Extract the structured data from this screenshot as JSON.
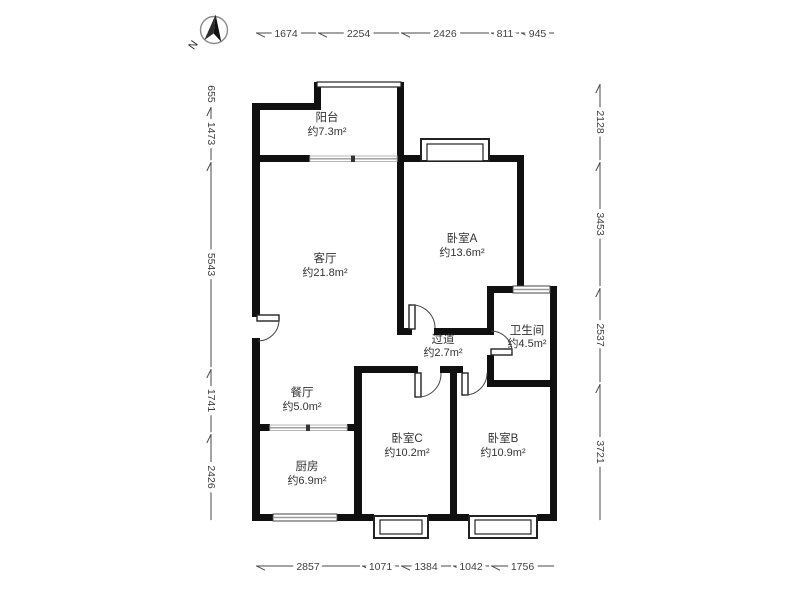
{
  "compass": {
    "label": "N"
  },
  "rooms": [
    {
      "id": "balcony",
      "name": "阳台",
      "area": "约7.3m²"
    },
    {
      "id": "living",
      "name": "客厅",
      "area": "约21.8m²"
    },
    {
      "id": "bedroomA",
      "name": "卧室A",
      "area": "约13.6m²"
    },
    {
      "id": "hallway",
      "name": "过道",
      "area": "约2.7m²"
    },
    {
      "id": "bathroom",
      "name": "卫生间",
      "area": "约4.5m²"
    },
    {
      "id": "dining",
      "name": "餐厅",
      "area": "约5.0m²"
    },
    {
      "id": "kitchen",
      "name": "厨房",
      "area": "约6.9m²"
    },
    {
      "id": "bedroomC",
      "name": "卧室C",
      "area": "约10.2m²"
    },
    {
      "id": "bedroomB",
      "name": "卧室B",
      "area": "约10.9m²"
    }
  ],
  "dimensions": {
    "top": [
      "1674",
      "2254",
      "2426",
      "811",
      "945"
    ],
    "left": [
      "655",
      "1473",
      "5543",
      "1741",
      "2426"
    ],
    "right": [
      "2128",
      "3453",
      "2537",
      "3721"
    ],
    "bottom": [
      "2857",
      "1071",
      "1384",
      "1042",
      "1756"
    ]
  },
  "colors": {
    "wall": "#101010",
    "dimension": "#4a4a4a",
    "glass": "#9a9a9a",
    "text": "#333333"
  }
}
